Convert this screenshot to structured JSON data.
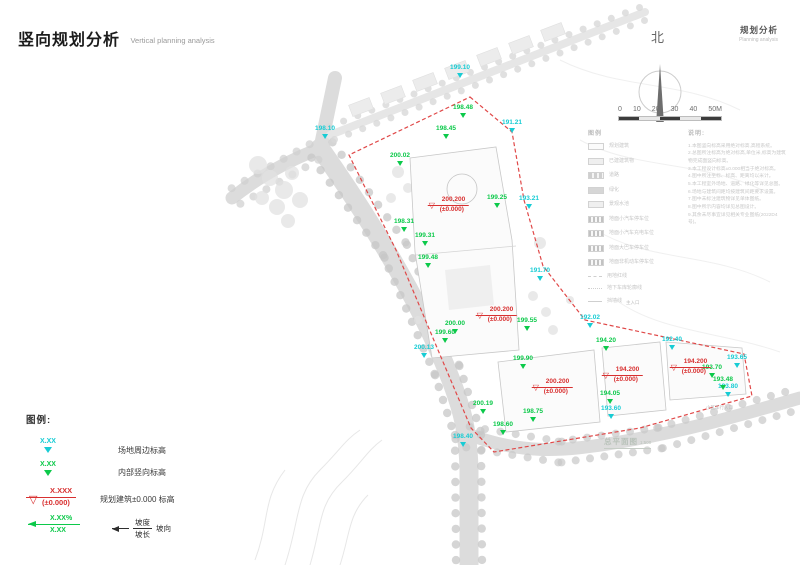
{
  "header": {
    "title_cn": "竖向规划分析",
    "title_en": "Vertical planning analysis",
    "corner_cn": "规划分析",
    "corner_en": "Planning analysis"
  },
  "north": {
    "label": "北"
  },
  "scale_bar": {
    "labels": [
      "0",
      "10",
      "20",
      "30",
      "40",
      "50M"
    ]
  },
  "legend": {
    "title": "图例:",
    "site_value": "X.XX",
    "site_label": "场地周边标高",
    "internal_value": "X.XX",
    "internal_label": "内部竖向标高",
    "datum_value": "X.XXX",
    "datum_sub": "(±0.000)",
    "datum_label": "规划建筑±0.000 标高",
    "slope_value": "X.XX%",
    "slope_length": "X.XX",
    "slope_num": "坡度",
    "slope_den": "坡长",
    "slope_dir": "坡向"
  },
  "map": {
    "boundary_points": "470,97 512,132 524,200 543,266 585,320 744,354 752,396 640,428 494,452 471,428 438,350 396,250 349,155",
    "site_markers": [
      {
        "v": "199.10",
        "x": 460,
        "y": 65
      },
      {
        "v": "198.10",
        "x": 325,
        "y": 126
      },
      {
        "v": "191.21",
        "x": 512,
        "y": 120
      },
      {
        "v": "193.21",
        "x": 529,
        "y": 196
      },
      {
        "v": "191.70",
        "x": 540,
        "y": 268
      },
      {
        "v": "200.13",
        "x": 424,
        "y": 345
      },
      {
        "v": "192.02",
        "x": 590,
        "y": 315
      },
      {
        "v": "192.40",
        "x": 672,
        "y": 337
      },
      {
        "v": "193.65",
        "x": 737,
        "y": 355
      },
      {
        "v": "193.80",
        "x": 728,
        "y": 384
      },
      {
        "v": "193.60",
        "x": 611,
        "y": 406
      },
      {
        "v": "198.40",
        "x": 463,
        "y": 434
      }
    ],
    "internal_markers": [
      {
        "v": "198.48",
        "x": 463,
        "y": 105
      },
      {
        "v": "198.45",
        "x": 446,
        "y": 126
      },
      {
        "v": "200.02",
        "x": 400,
        "y": 153
      },
      {
        "v": "199.25",
        "x": 497,
        "y": 195
      },
      {
        "v": "198.31",
        "x": 404,
        "y": 219
      },
      {
        "v": "199.31",
        "x": 425,
        "y": 233
      },
      {
        "v": "199.48",
        "x": 428,
        "y": 255
      },
      {
        "v": "200.00",
        "x": 455,
        "y": 321
      },
      {
        "v": "199.55",
        "x": 527,
        "y": 318
      },
      {
        "v": "194.20",
        "x": 606,
        "y": 338
      },
      {
        "v": "199.90",
        "x": 523,
        "y": 356
      },
      {
        "v": "199.60",
        "x": 445,
        "y": 330
      },
      {
        "v": "200.19",
        "x": 483,
        "y": 401
      },
      {
        "v": "198.75",
        "x": 533,
        "y": 409
      },
      {
        "v": "198.60",
        "x": 503,
        "y": 422
      },
      {
        "v": "194.05",
        "x": 610,
        "y": 391
      },
      {
        "v": "193.70",
        "x": 712,
        "y": 365
      },
      {
        "v": "193.48",
        "x": 723,
        "y": 377
      }
    ],
    "datums": [
      {
        "v": "200.200",
        "s": "(±0.000)",
        "x": 448,
        "y": 196
      },
      {
        "v": "200.200",
        "s": "(±0.000)",
        "x": 496,
        "y": 306
      },
      {
        "v": "200.200",
        "s": "(±0.000)",
        "x": 552,
        "y": 378
      },
      {
        "v": "194.200",
        "s": "(±0.000)",
        "x": 622,
        "y": 366
      },
      {
        "v": "194.200",
        "s": "(±0.000)",
        "x": 690,
        "y": 358
      }
    ],
    "plan_title": {
      "text": "总平面图",
      "scale": "1:500"
    },
    "faint_labels": [
      {
        "t": "主入口",
        "x": 626,
        "y": 300
      },
      {
        "t": "小区车行入口",
        "x": 706,
        "y": 405
      }
    ]
  },
  "base_legend": {
    "title": "图例",
    "box_items": [
      {
        "label": "规划建筑",
        "tone": "outline"
      },
      {
        "label": "已建建筑物",
        "tone": "light"
      },
      {
        "label": "道路",
        "tone": "bars"
      },
      {
        "label": "绿化",
        "tone": "dark"
      },
      {
        "label": "景观水池",
        "tone": "light"
      },
      {
        "label": "地面小汽车停车位",
        "tone": "dashes"
      },
      {
        "label": "地面小汽车充电车位",
        "tone": "dashes"
      },
      {
        "label": "地面大巴车停车位",
        "tone": "dashes"
      },
      {
        "label": "地面非机动车停车位",
        "tone": "dashes"
      }
    ],
    "line_items": [
      {
        "label": "用地红线",
        "style": "dash"
      },
      {
        "label": "地下车库轮廓线",
        "style": "dashdot"
      },
      {
        "label": "挡墙线",
        "style": "solid"
      }
    ]
  },
  "notes": {
    "title": "说明:",
    "lines": [
      "1.本图竖向标高采用绝对标高,高程系统。",
      "2.总图所注标高为绝对标高,单位米,标高为建筑物完成面竖向标高。",
      "3.本工程设计标高±0.000相当于绝对标高。",
      "4.图中所注坐标、标高、距离均以米计。",
      "5.本工程室外场地、道路、绿化等详见总图。",
      "6.场地与建筑间距均按建筑间距要求设置。",
      "7.图中未标注建筑物详见单体图纸。",
      "8.图中所示内容均详见总图设计。",
      "9.其余未尽事宜详见相关专业图纸(2022D4号)。"
    ]
  }
}
